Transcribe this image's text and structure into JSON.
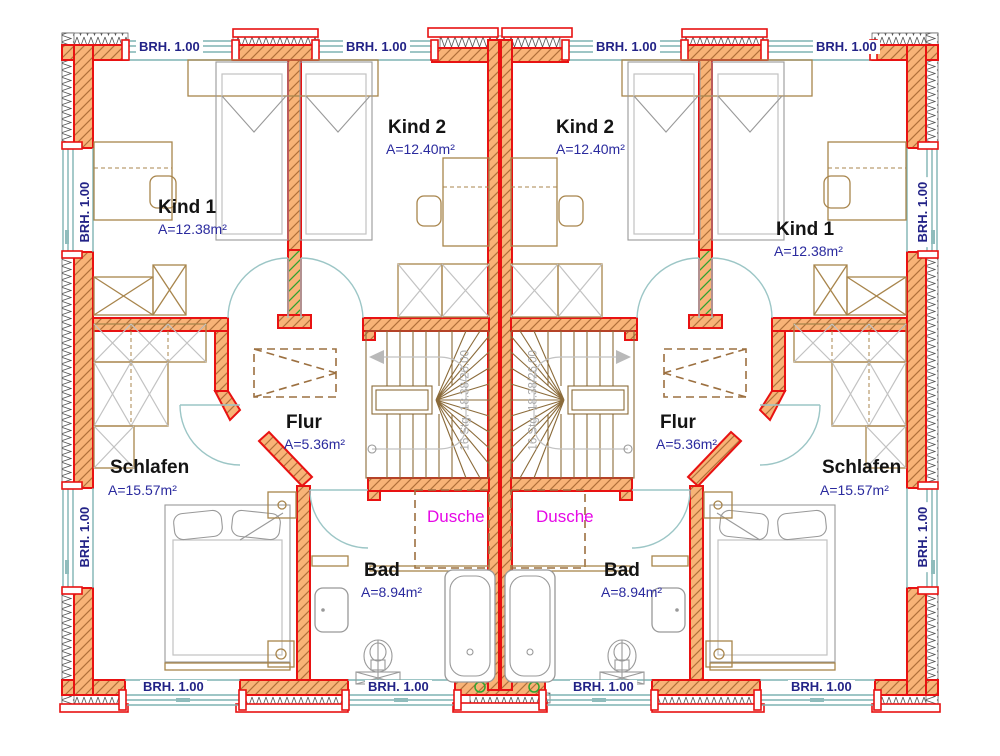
{
  "plan": {
    "rooms": [
      {
        "name": "Kind 1",
        "area": "A=12.38m²"
      },
      {
        "name": "Kind 2",
        "area": "A=12.40m²"
      },
      {
        "name": "Flur",
        "area": "A=5.36m²"
      },
      {
        "name": "Schlafen",
        "area": "A=15.57m²"
      },
      {
        "name": "Bad",
        "area": "A=8.94m²"
      },
      {
        "name": "Dusche"
      }
    ],
    "annotations": {
      "parapet": "BRH. 1.00",
      "stairs": "16 Stg. 18.38/26.00"
    },
    "colors": {
      "wall_fill": "#F8B377",
      "wall_outline": "#E81212",
      "hatch": "#B0703A",
      "hatch_accent": "#2FA32F",
      "window": "#7FB3B3",
      "door": "#9CC6C6",
      "text_room": "#141414",
      "text_area": "#2A2A9E",
      "text_dusche": "#E608E6",
      "furniture_wood": "#A8854C",
      "furniture_fixture": "#9A9A9A"
    }
  }
}
